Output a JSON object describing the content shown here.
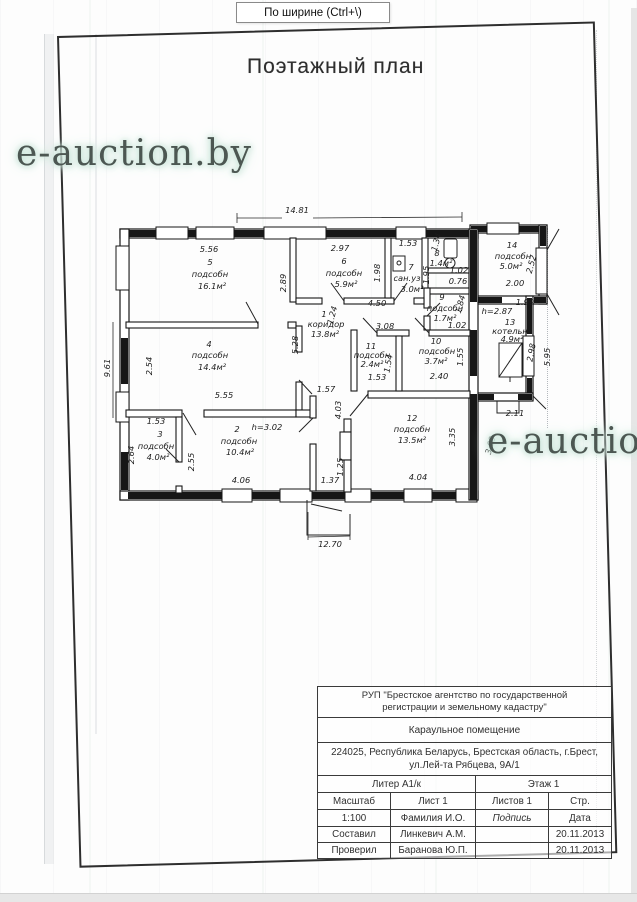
{
  "viewer": {
    "tooltip": "По ширине (Ctrl+\\)"
  },
  "page": {
    "title": "Поэтажный план",
    "watermark1": "e-auction.by",
    "watermark2": "e-auction.by"
  },
  "plan": {
    "overall_dims": {
      "top_width": "14.81",
      "left_height": "9.61",
      "bottom_porch": "12.70"
    },
    "rooms": [
      {
        "num": "1",
        "name": "коридор",
        "area": "13.8м²"
      },
      {
        "num": "2",
        "name": "подсобн",
        "area": "10.4м²",
        "height": "h=3.02"
      },
      {
        "num": "3",
        "name": "подсобн",
        "area": "4.0м²"
      },
      {
        "num": "4",
        "name": "подсобн",
        "area": "14.4м²"
      },
      {
        "num": "5",
        "name": "подсобн",
        "area": "16.1м²"
      },
      {
        "num": "6",
        "name": "подсобн",
        "area": "5.9м²"
      },
      {
        "num": "7",
        "name": "сан.уз",
        "area": "3.0м²"
      },
      {
        "num": "8",
        "name": "",
        "area": "1.4м²"
      },
      {
        "num": "9",
        "name": "подсобн",
        "area": "1.7м²"
      },
      {
        "num": "10",
        "name": "подсобн",
        "area": "3.7м²"
      },
      {
        "num": "11",
        "name": "подсобн",
        "area": "2.4м²"
      },
      {
        "num": "12",
        "name": "подсобн",
        "area": "13.5м²"
      },
      {
        "num": "13",
        "name": "котельн",
        "area": "4.9м²",
        "height": "h=2.87"
      },
      {
        "num": "14",
        "name": "подсобн",
        "area": "5.0м²"
      }
    ],
    "labels": [
      {
        "t": "14.81",
        "x": 297,
        "y": 213
      },
      {
        "t": "9.61",
        "x": 110,
        "y": 368,
        "r": -90
      },
      {
        "t": "5.56",
        "x": 209,
        "y": 252
      },
      {
        "t": "5",
        "x": 210,
        "y": 265,
        "n": "room-5-number"
      },
      {
        "t": "подсобн",
        "x": 210,
        "y": 277,
        "n": "room-5-name"
      },
      {
        "t": "16.1м²",
        "x": 212,
        "y": 289,
        "n": "room-5-area"
      },
      {
        "t": "2.89",
        "x": 286,
        "y": 283,
        "r": -90
      },
      {
        "t": "2.97",
        "x": 340,
        "y": 251
      },
      {
        "t": "6",
        "x": 344,
        "y": 264,
        "n": "room-6-number"
      },
      {
        "t": "подсобн",
        "x": 344,
        "y": 276,
        "n": "room-6-name"
      },
      {
        "t": "5.9м²",
        "x": 346,
        "y": 287,
        "n": "room-6-area"
      },
      {
        "t": "1.98",
        "x": 380,
        "y": 273,
        "r": -90
      },
      {
        "t": "1.53",
        "x": 408,
        "y": 246
      },
      {
        "t": "7",
        "x": 411,
        "y": 270,
        "n": "room-7-number"
      },
      {
        "t": "сан.уз",
        "x": 407,
        "y": 281,
        "n": "room-7-name"
      },
      {
        "t": "3.0м²",
        "x": 412,
        "y": 292,
        "n": "room-7-area"
      },
      {
        "t": "1.95",
        "x": 429,
        "y": 275,
        "r": -90
      },
      {
        "t": "1.34",
        "x": 439,
        "y": 243,
        "r": -75
      },
      {
        "t": "8",
        "x": 437,
        "y": 256,
        "n": "room-8-number"
      },
      {
        "t": "1.4м²",
        "x": 441,
        "y": 266,
        "n": "room-8-area"
      },
      {
        "t": "1.02",
        "x": 459,
        "y": 273
      },
      {
        "t": "0.76",
        "x": 458,
        "y": 284
      },
      {
        "t": "9",
        "x": 442,
        "y": 300,
        "n": "room-9-number"
      },
      {
        "t": "подсобн",
        "x": 445,
        "y": 311,
        "n": "room-9-name"
      },
      {
        "t": "1.7м²",
        "x": 445,
        "y": 321,
        "n": "room-9-area"
      },
      {
        "t": "1.84",
        "x": 463,
        "y": 305,
        "r": -75
      },
      {
        "t": "1.02",
        "x": 457,
        "y": 328
      },
      {
        "t": "h=2.87",
        "x": 497,
        "y": 314
      },
      {
        "t": "14",
        "x": 512,
        "y": 248,
        "n": "room-14-number"
      },
      {
        "t": "подсобн",
        "x": 513,
        "y": 259,
        "n": "room-14-name"
      },
      {
        "t": "5.0м²",
        "x": 511,
        "y": 269,
        "n": "room-14-area"
      },
      {
        "t": "2.52",
        "x": 534,
        "y": 265,
        "r": -75
      },
      {
        "t": "2.00",
        "x": 515,
        "y": 286
      },
      {
        "t": "1.99",
        "x": 525,
        "y": 305
      },
      {
        "t": "13",
        "x": 510,
        "y": 325,
        "n": "room-13-number"
      },
      {
        "t": "котельн",
        "x": 510,
        "y": 334,
        "n": "room-13-name"
      },
      {
        "t": "4.9м²",
        "x": 512,
        "y": 342,
        "n": "room-13-area"
      },
      {
        "t": "2.98",
        "x": 534,
        "y": 353,
        "r": -80
      },
      {
        "t": "5.95",
        "x": 550,
        "y": 357,
        "r": -90
      },
      {
        "t": "2.11",
        "x": 515,
        "y": 416
      },
      {
        "t": "3.69",
        "x": 493,
        "y": 446,
        "r": -75
      },
      {
        "t": "1",
        "x": 324,
        "y": 317,
        "n": "room-1-number"
      },
      {
        "t": "коридор",
        "x": 326,
        "y": 327,
        "n": "room-1-name"
      },
      {
        "t": "13.8м²",
        "x": 325,
        "y": 337,
        "n": "room-1-area"
      },
      {
        "t": "5.28",
        "x": 298,
        "y": 345,
        "r": -90
      },
      {
        "t": "4.50",
        "x": 377,
        "y": 306
      },
      {
        "t": "3.08",
        "x": 385,
        "y": 329
      },
      {
        "t": "1.24",
        "x": 335,
        "y": 316,
        "r": -75
      },
      {
        "t": "11",
        "x": 371,
        "y": 349,
        "n": "room-11-number"
      },
      {
        "t": "подсобн",
        "x": 372,
        "y": 358,
        "n": "room-11-name"
      },
      {
        "t": "2.4м²",
        "x": 372,
        "y": 367,
        "n": "room-11-area"
      },
      {
        "t": "1.54",
        "x": 391,
        "y": 364,
        "r": -80
      },
      {
        "t": "1.53",
        "x": 377,
        "y": 380
      },
      {
        "t": "10",
        "x": 436,
        "y": 344,
        "n": "room-10-number"
      },
      {
        "t": "подсобн",
        "x": 437,
        "y": 354,
        "n": "room-10-name"
      },
      {
        "t": "3.7м²",
        "x": 436,
        "y": 364,
        "n": "room-10-area"
      },
      {
        "t": "2.40",
        "x": 439,
        "y": 379
      },
      {
        "t": "1.55",
        "x": 463,
        "y": 357,
        "r": -90
      },
      {
        "t": "12",
        "x": 412,
        "y": 421,
        "n": "room-12-number"
      },
      {
        "t": "подсобн",
        "x": 412,
        "y": 432,
        "n": "room-12-name"
      },
      {
        "t": "13.5м²",
        "x": 412,
        "y": 443,
        "n": "room-12-area"
      },
      {
        "t": "3.35",
        "x": 455,
        "y": 437,
        "r": -90
      },
      {
        "t": "4.04",
        "x": 418,
        "y": 480
      },
      {
        "t": "4.03",
        "x": 341,
        "y": 410,
        "r": -90
      },
      {
        "t": "1.25",
        "x": 343,
        "y": 467,
        "r": -90
      },
      {
        "t": "1.37",
        "x": 330,
        "y": 483
      },
      {
        "t": "1.57",
        "x": 326,
        "y": 392
      },
      {
        "t": "4",
        "x": 209,
        "y": 347,
        "n": "room-4-number"
      },
      {
        "t": "подсобн",
        "x": 210,
        "y": 358,
        "n": "room-4-name"
      },
      {
        "t": "14.4м²",
        "x": 212,
        "y": 370,
        "n": "room-4-area"
      },
      {
        "t": "2.54",
        "x": 152,
        "y": 366,
        "r": -90
      },
      {
        "t": "5.55",
        "x": 224,
        "y": 398
      },
      {
        "t": "2",
        "x": 237,
        "y": 432,
        "n": "room-2-number"
      },
      {
        "t": "h=3.02",
        "x": 267,
        "y": 430
      },
      {
        "t": "подсобн",
        "x": 239,
        "y": 444,
        "n": "room-2-name"
      },
      {
        "t": "10.4м²",
        "x": 240,
        "y": 455,
        "n": "room-2-area"
      },
      {
        "t": "2.55",
        "x": 194,
        "y": 462,
        "r": -90
      },
      {
        "t": "4.06",
        "x": 241,
        "y": 483
      },
      {
        "t": "3",
        "x": 160,
        "y": 437,
        "n": "room-3-number"
      },
      {
        "t": "подсобн",
        "x": 156,
        "y": 449,
        "n": "room-3-name"
      },
      {
        "t": "4.0м²",
        "x": 158,
        "y": 460,
        "n": "room-3-area"
      },
      {
        "t": "1.53",
        "x": 156,
        "y": 424
      },
      {
        "t": "2.64",
        "x": 134,
        "y": 455,
        "r": -90
      },
      {
        "t": "12.70",
        "x": 330,
        "y": 547
      }
    ]
  },
  "tb": {
    "org_l1": "РУП \"Брестское агентство по государственной",
    "org_l2": "регистрации и земельному кадастру\"",
    "object": "Караульное помещение",
    "addr_l1": "224025, Республика Беларусь, Брестская область,  г.Брест,",
    "addr_l2": "ул.Лей-та Рябцева, 9А/1",
    "liter": "Литер А1/к",
    "floor": "Этаж 1",
    "scale_label": "Масштаб",
    "sheet": "Лист 1",
    "sheets": "Листов 1",
    "page": "Стр.",
    "scale": "1:100",
    "name_header": "Фамилия И.О.",
    "sign_header": "Подпись",
    "date_header": "Дата",
    "compiled_label": "Составил",
    "compiled_name": "Линкевич А.М.",
    "compiled_date": "20.11.2013",
    "checked_label": "Проверил",
    "checked_name": "Баранова Ю.П.",
    "checked_date": "20.11.2013"
  }
}
